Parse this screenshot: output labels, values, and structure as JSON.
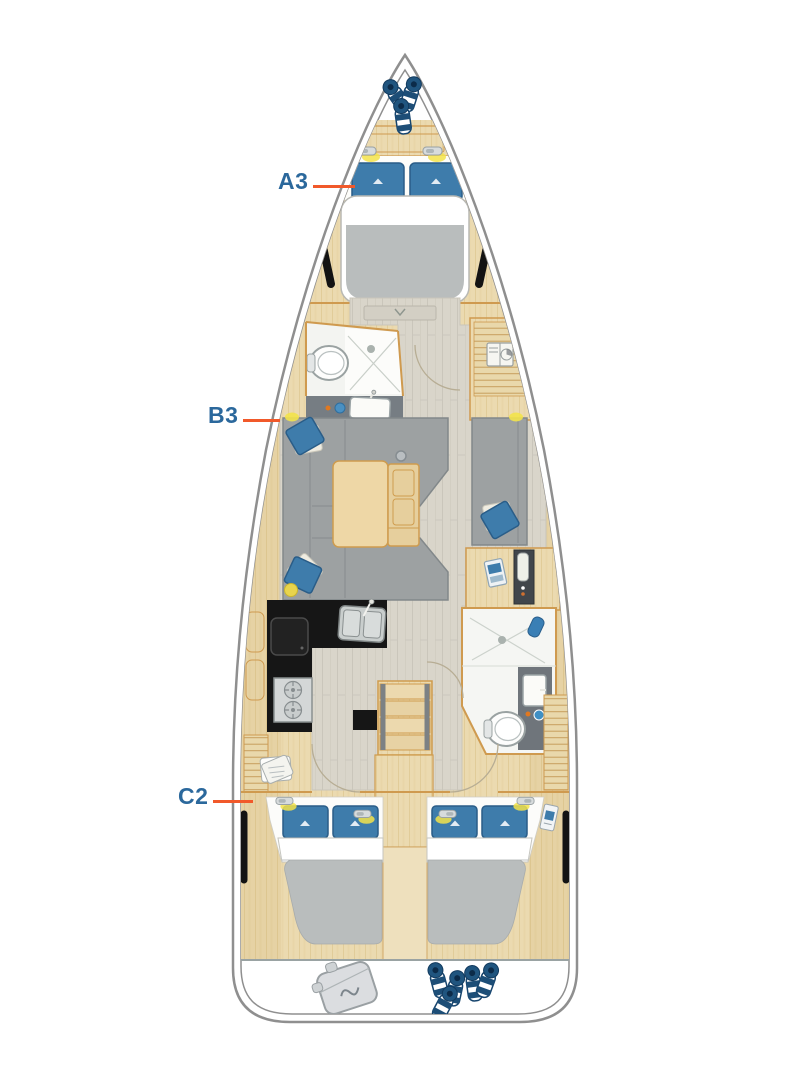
{
  "diagram": {
    "type": "sailing-yacht-interior-layout-plan",
    "cabin_labels": [
      {
        "id": "a3",
        "text": "A3",
        "points_to": "forward-cabin-double-berth"
      },
      {
        "id": "b3",
        "text": "B3",
        "points_to": "salon-port-sofa"
      },
      {
        "id": "c2",
        "text": "C2",
        "points_to": "aft-port-cabin"
      }
    ],
    "colors": {
      "label_text": "#2b689c",
      "pointer_line": "#f1592a",
      "hull_outline": "#8f8f8f",
      "wood": "#ebdab0",
      "wood_trim": "#cf9a4f",
      "floor_planks": "#d9d5ca",
      "upholstery_gray": "#9da1a2",
      "mattress_gray": "#b9bdbd",
      "cushion_blue": "#3e7cab",
      "fender_navy": "#1d4e77",
      "counter_black": "#161616",
      "vanity_gray": "#767d83",
      "accent_yellow": "#f3e34a"
    },
    "icons": [
      "bow-fenders-icon",
      "reading-light-icon",
      "pillow-icon",
      "berth-icon",
      "toilet-icon",
      "shower-icon",
      "vanity-sink-icon",
      "washing-machine-icon",
      "wardrobe-slats-icon",
      "galley-sink-icon",
      "stove-icon",
      "fridge-icon",
      "companionway-stairs-icon",
      "salon-table-icon",
      "nav-locker-icon",
      "laundry-bag-icon",
      "fender-bag-icon",
      "stern-fenders-icon",
      "mast-post-icon",
      "door-swing-icon",
      "hull-window-icon"
    ]
  }
}
